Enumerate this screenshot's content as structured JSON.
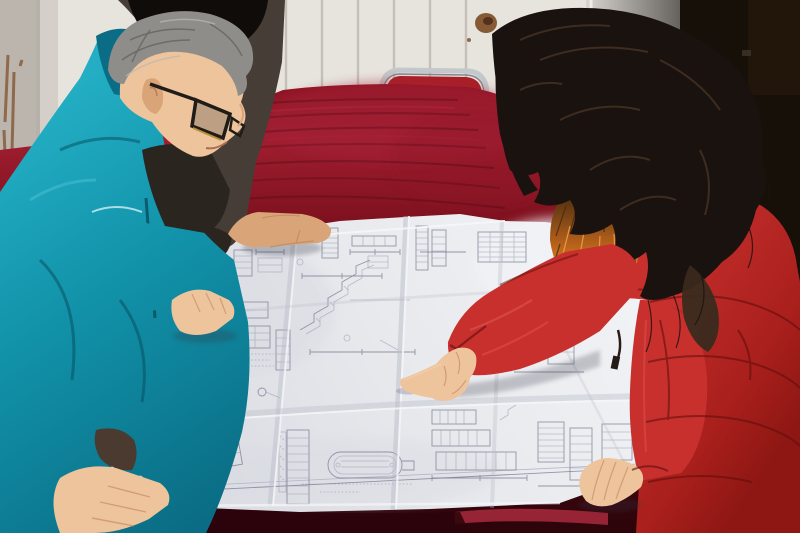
{
  "meta": {
    "title": "Two workers and a colleague reviewing a large unfolded engineering blueprint on a table covered with dark red velvet cloth",
    "type": "photograph"
  },
  "scene": {
    "wall": {
      "label": "white ribbed wall panel with rust stains"
    },
    "door": {
      "label": "dark door panel on the right"
    },
    "chair": {
      "label": "red upholstered chair with metal frame behind the table"
    },
    "table": {
      "label": "table draped in dark red velvet cloth"
    },
    "blueprint": {
      "label": "large unfolded engineering drawing with fold creases"
    },
    "man": {
      "label": "gray-haired man in teal work jacket and glasses leaning over the drawing"
    },
    "colleague": {
      "label": "colleague in dark jacket resting a hand on the drawing"
    },
    "woman": {
      "label": "woman in red down coat with fur collar pointing at the drawing"
    }
  },
  "colors": {
    "wall": "#e7e4de",
    "wallShadow": "#b3ada4",
    "wallLine": "#bdb7ae",
    "rust": "#7c4a24",
    "rustDark": "#55301a",
    "doorLight": "#d8d5d0",
    "doorDark": "#5e5b57",
    "doorEdge": "#f4f3f0",
    "darkPanel": "#171009",
    "panelBrown": "#2a1a0c",
    "chairFrame": "#c3c8cc",
    "chairFrameDark": "#85898d",
    "chairRed": "#a81f26",
    "clothTop": "#8e1423",
    "clothBright": "#a01e30",
    "clothMid": "#6e0d1b",
    "clothDark": "#470811",
    "clothDeep": "#2b040a",
    "clothFringe": "#a32838",
    "clothStreak": "#230208",
    "paperLight": "#f2f3f6",
    "paper": "#e8e9ed",
    "paperShade": "#d9dbe2",
    "crease": "#b9bdc8",
    "creaseLight": "#f5f6f9",
    "line": "#7b8094",
    "lineSoft": "#9aa0b2",
    "tealLight": "#23aec4",
    "teal": "#1191a8",
    "tealDark": "#0a6d85",
    "tealDeep": "#074c5e",
    "tealHi": "#49c3d4",
    "skin": "#eec49c",
    "skinMid": "#d9a578",
    "skinShadow": "#b97f55",
    "hairGray": "#8f8d89",
    "hairGrayDark": "#5f5d59",
    "hairGrayLight": "#bab8b4",
    "darkCoat": "#453d36",
    "darkCoatDark": "#2b2520",
    "colleagueHair": "#100c0a",
    "hairBlack": "#1a120e",
    "hairBrown": "#3a2a1e",
    "hairSheen": "#5c4330",
    "coatRed": "#c8302e",
    "coatRedLight": "#e05a4e",
    "coatRedDark": "#8e1713",
    "coatRedDeep": "#5c0d0b",
    "fur": "#c2671c",
    "furDark": "#4e2e10",
    "furLight": "#eda04a",
    "glassFrame": "#201c18",
    "glassGold": "#b98f3e",
    "softShadow": "#343846"
  }
}
